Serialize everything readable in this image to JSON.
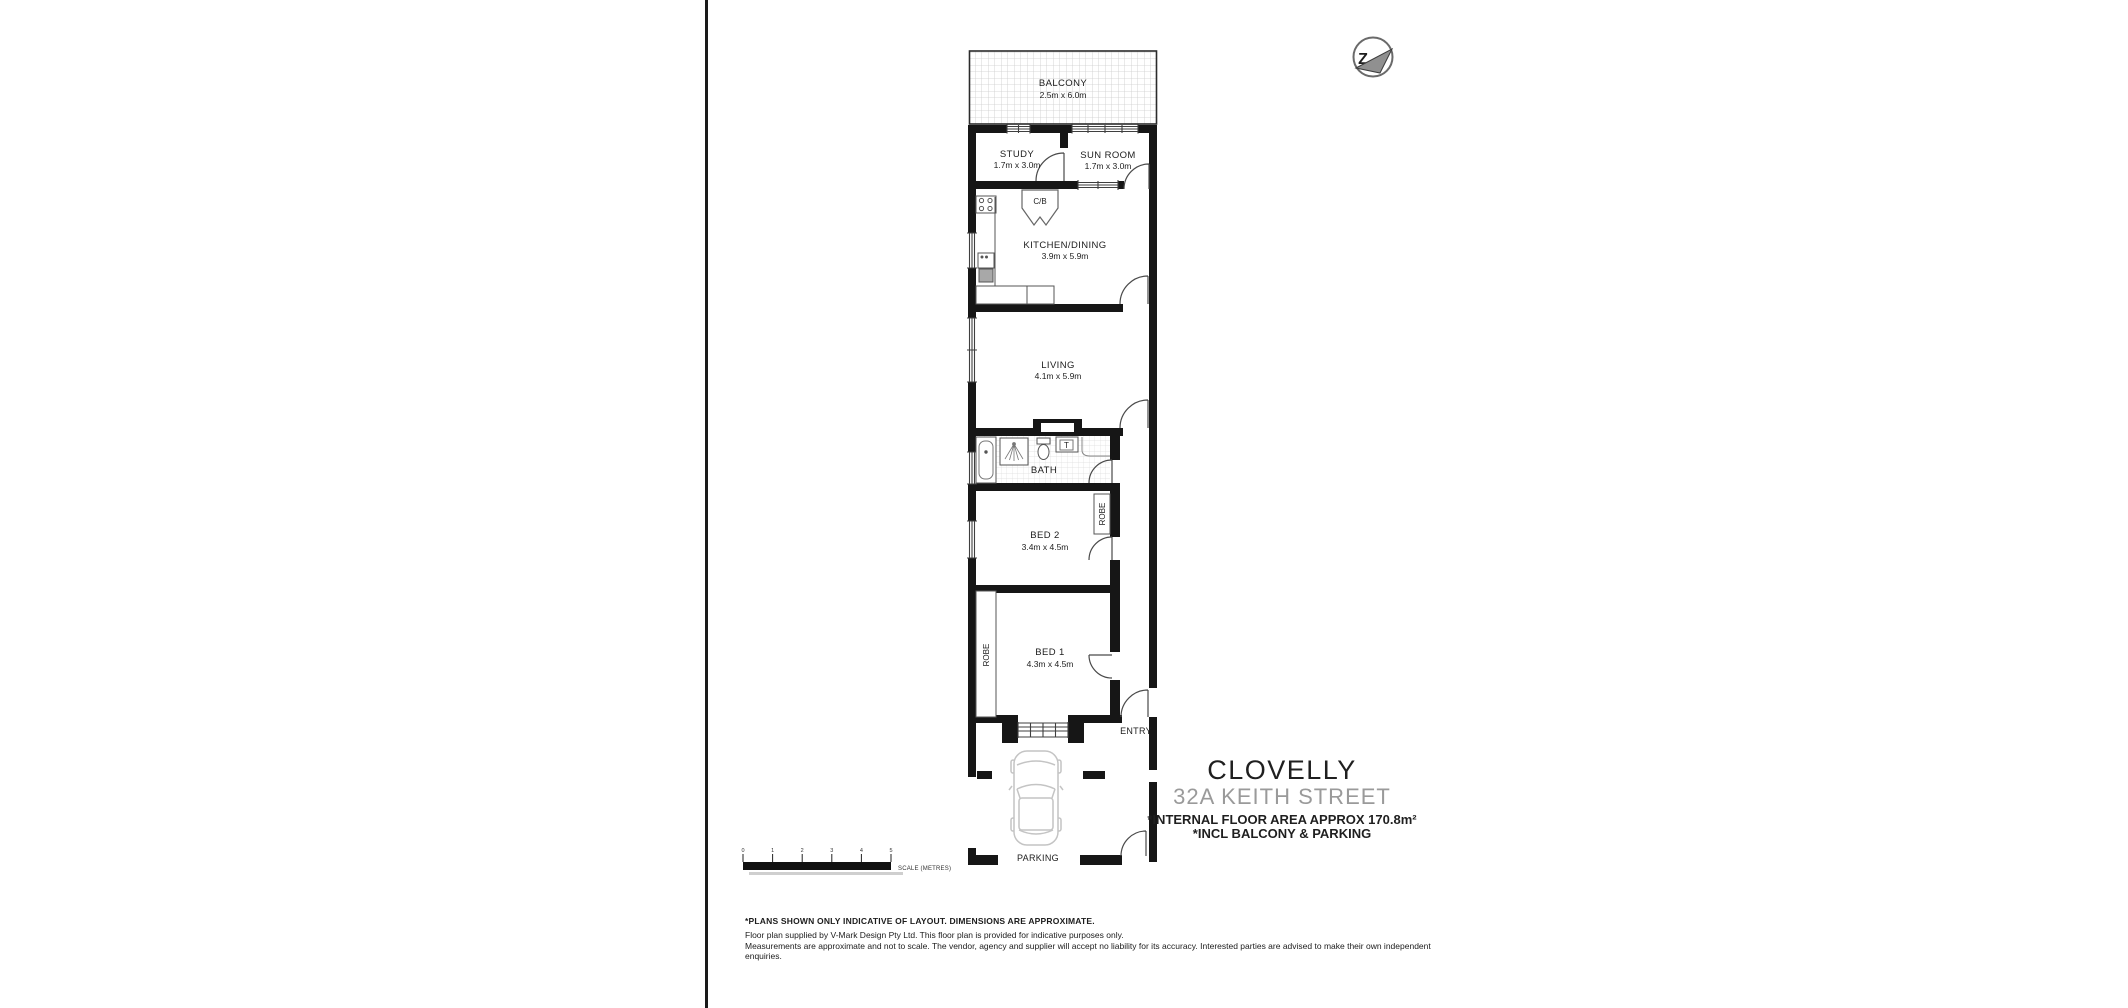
{
  "rooms": {
    "balcony": {
      "name": "BALCONY",
      "dims": "2.5m x 6.0m"
    },
    "study": {
      "name": "STUDY",
      "dims": "1.7m x 3.0m"
    },
    "sunroom": {
      "name": "SUN ROOM",
      "dims": "1.7m x 3.0m"
    },
    "kitchen": {
      "name": "KITCHEN/DINING",
      "dims": "3.9m x 5.9m"
    },
    "living": {
      "name": "LIVING",
      "dims": "4.1m x 5.9m"
    },
    "bath": {
      "name": "BATH"
    },
    "bed2": {
      "name": "BED 2",
      "dims": "3.4m x 4.5m"
    },
    "bed1": {
      "name": "BED 1",
      "dims": "4.3m x 4.5m"
    },
    "entry": {
      "name": "ENTRY"
    },
    "parking": {
      "name": "PARKING"
    }
  },
  "fixtures": {
    "robe_bed1": "ROBE",
    "robe_bed2": "ROBE",
    "cupboard": "C/B",
    "vanity": "T"
  },
  "title_block": {
    "suburb": "CLOVELLY",
    "address": "32A KEITH STREET",
    "area_line": "*INTERNAL FLOOR AREA APPROX 170.8m²",
    "incl_line": "*INCL BALCONY & PARKING"
  },
  "scale_bar": {
    "ticks": [
      "0",
      "1",
      "2",
      "3",
      "4",
      "5"
    ],
    "label": "SCALE (METRES)"
  },
  "disclaimer": {
    "line1": "*PLANS SHOWN ONLY INDICATIVE OF LAYOUT. DIMENSIONS ARE APPROXIMATE.",
    "line2": "Floor plan supplied by V-Mark Design Pty Ltd. This floor plan is provided for indicative purposes only.",
    "line3": "Measurements are approximate and not to scale. The vendor, agency and supplier will accept no liability for its accuracy. Interested parties are advised to make their own independent enquiries."
  },
  "logo": {
    "letter": "Z"
  },
  "colors": {
    "wall": "#161616",
    "accent_gray": "#9a9a9a"
  }
}
